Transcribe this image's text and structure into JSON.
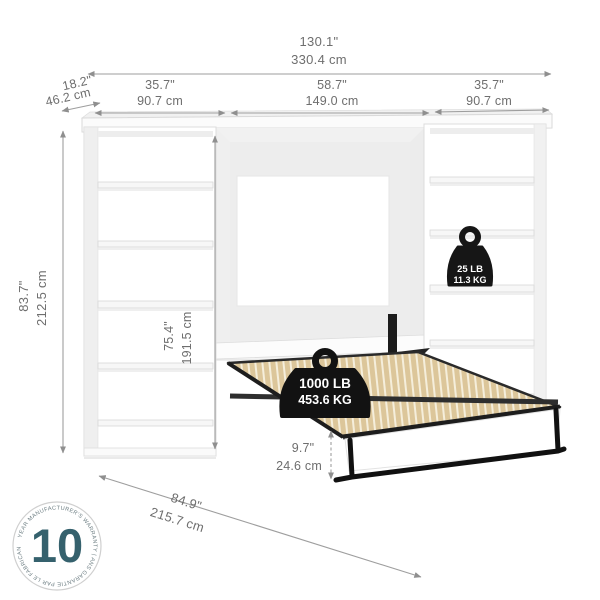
{
  "product": {
    "name": "murphy-bed-with-two-bookcases-dimension-diagram"
  },
  "dimensions": {
    "overall_width": {
      "in": "130.1\"",
      "cm": "330.4 cm"
    },
    "depth": {
      "in": "18.2\"",
      "cm": "46.2 cm"
    },
    "left_section": {
      "in": "35.7\"",
      "cm": "90.7 cm"
    },
    "center_section": {
      "in": "58.7\"",
      "cm": "149.0 cm"
    },
    "right_section": {
      "in": "35.7\"",
      "cm": "90.7 cm"
    },
    "overall_height": {
      "in": "83.7\"",
      "cm": "212.5 cm"
    },
    "opening_height": {
      "in": "75.4\"",
      "cm": "191.5 cm"
    },
    "floor_clearance": {
      "in": "9.7\"",
      "cm": "24.6 cm"
    },
    "open_depth": {
      "in": "84.9\"",
      "cm": "215.7 cm"
    }
  },
  "weights": {
    "shelf_capacity": {
      "lb": "25 LB",
      "kg": "11.3 KG"
    },
    "bed_capacity": {
      "lb": "1000 LB",
      "kg": "453.6 KG"
    }
  },
  "warranty": {
    "years": "10",
    "ring_text": "YEAR MANUFACTURER'S WARRANTY | ANS GARANTIE PAR LE FABRICANT |"
  },
  "colors": {
    "accent_teal": "#35616d",
    "dimension_gray": "#9e9e9e",
    "slat_tan": "#dcc69a",
    "frame_black": "#1c1c1c",
    "furniture_white": "#ffffff"
  }
}
